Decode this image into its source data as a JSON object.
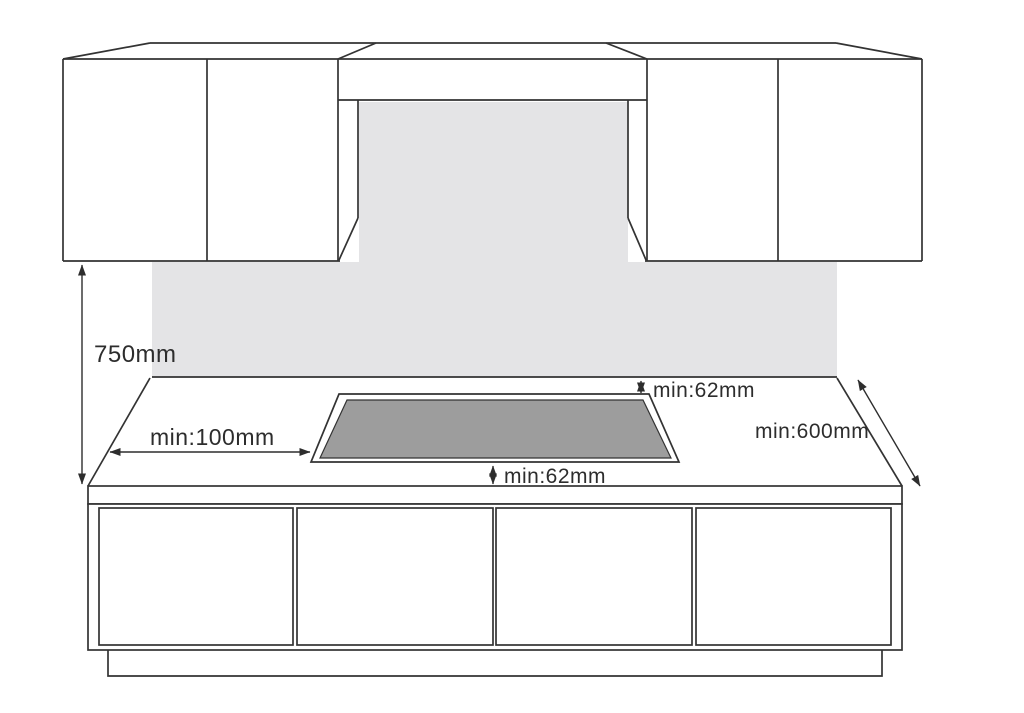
{
  "diagram": {
    "type": "installation-clearance-diagram",
    "subject": "Built-in hob / cooktop minimum installation clearances in kitchen worktop",
    "background_color": "#ffffff",
    "line_color": "#333333",
    "text_color": "#2d2d2d",
    "backsplash_color": "#e4e4e6",
    "cooktop_fill_color": "#9d9d9d",
    "dimensions": {
      "cabinet_to_worktop_height": "750mm",
      "left_side_clearance": "min:100mm",
      "rear_clearance": "min:62mm",
      "front_clearance": "min:62mm",
      "worktop_depth": "min:600mm"
    }
  }
}
